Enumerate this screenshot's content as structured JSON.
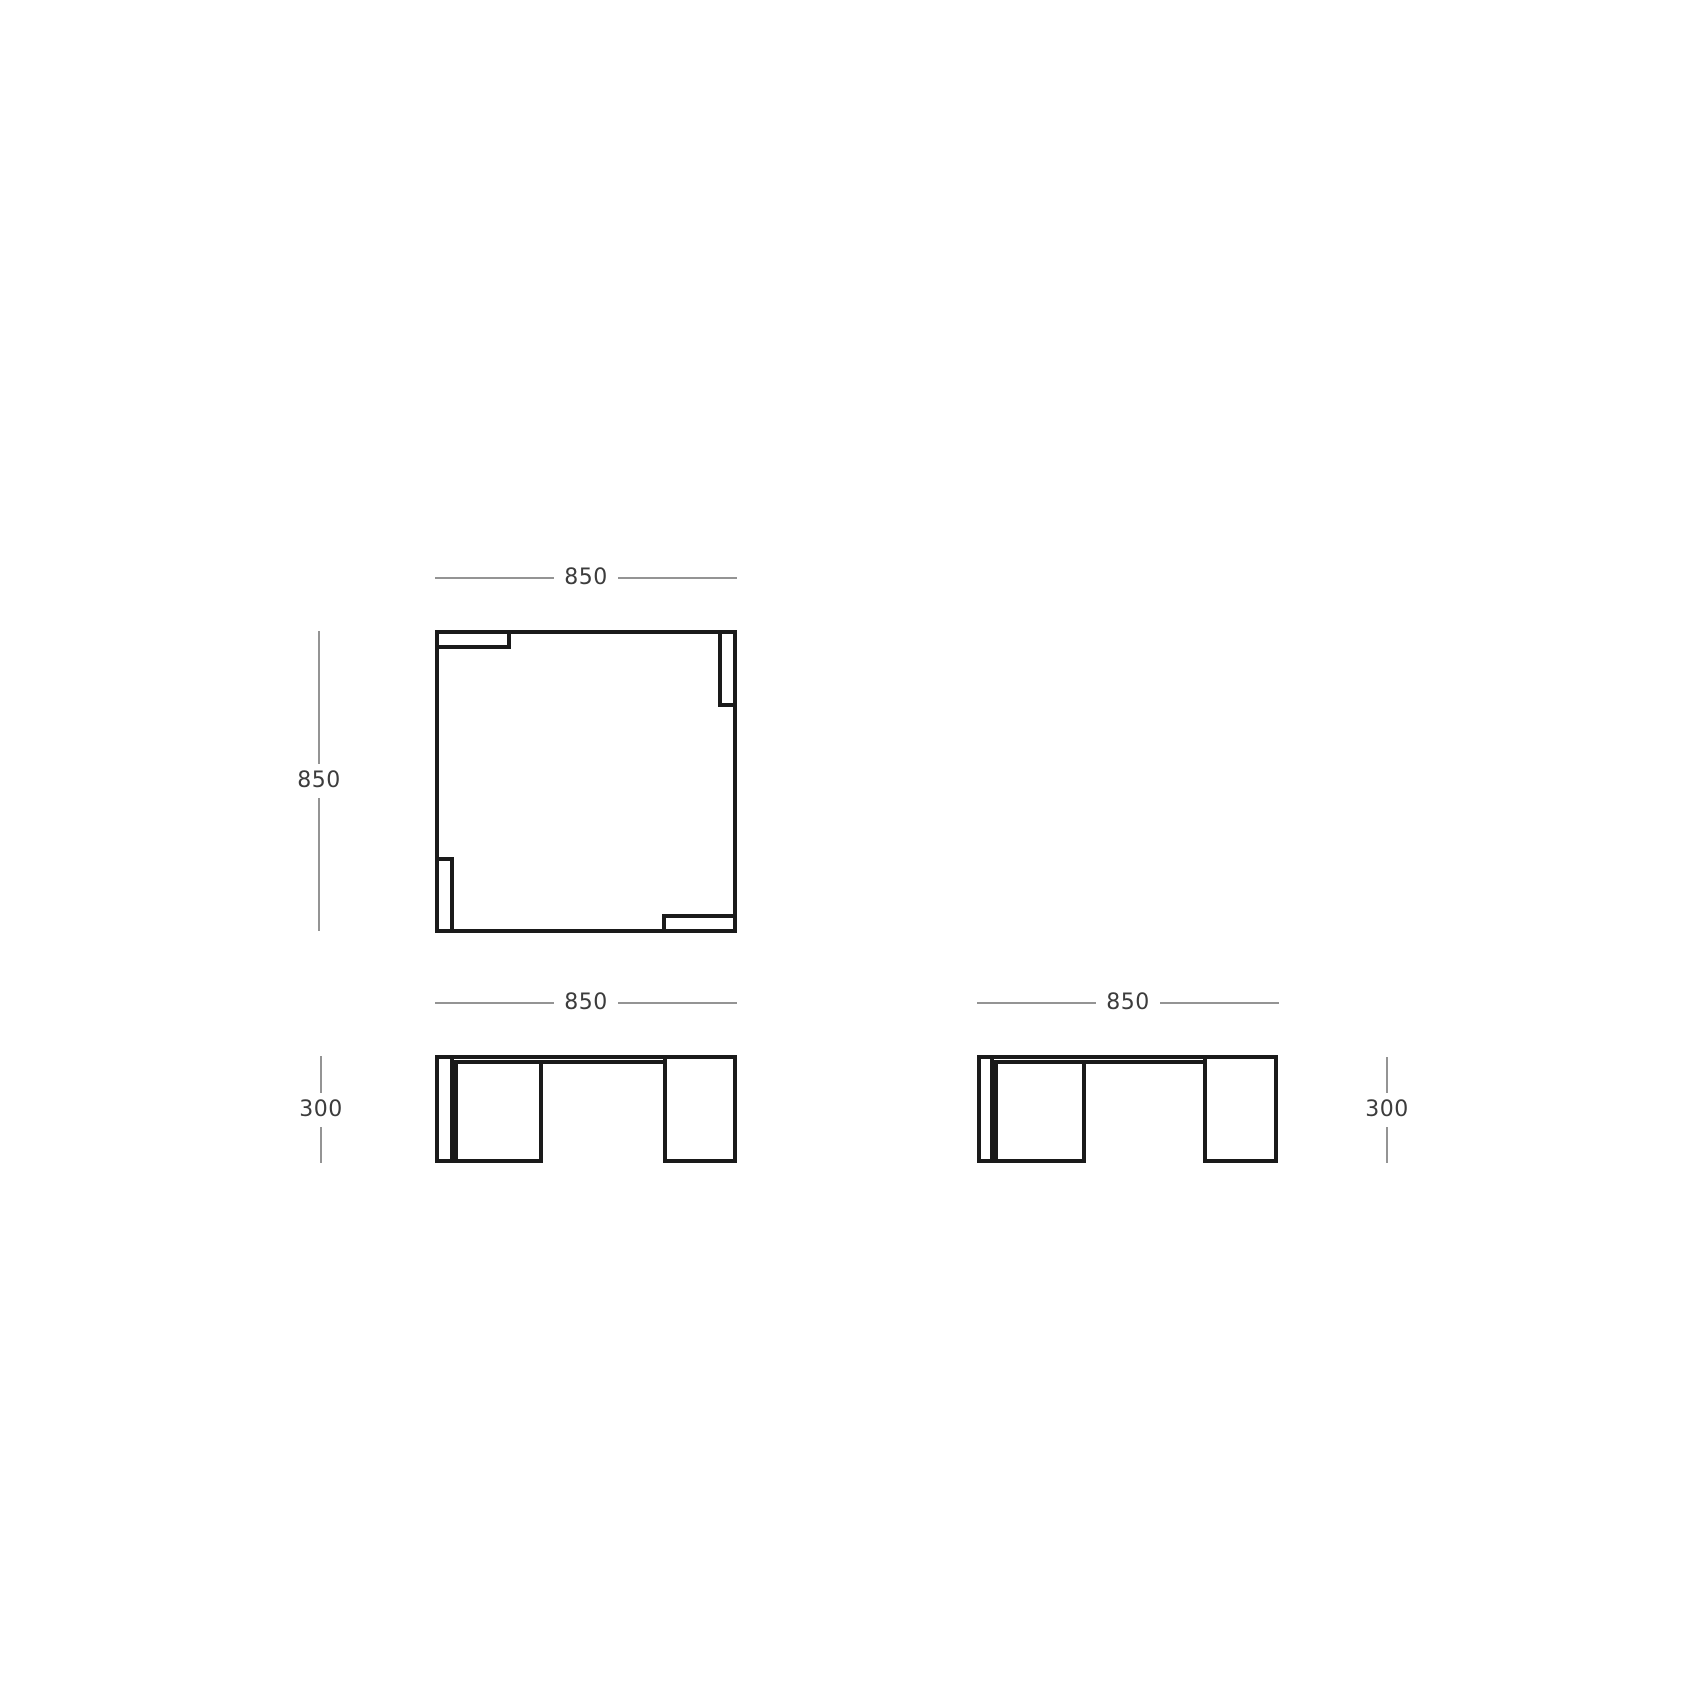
{
  "views": {
    "plan": {
      "width_label": "850",
      "height_label": "850"
    },
    "front": {
      "width_label": "850",
      "height_label": "300"
    },
    "side": {
      "width_label": "850",
      "height_label": "300"
    }
  },
  "colors": {
    "drawing_line": "#1a1a1a",
    "dimension_line": "#949494",
    "dimension_text": "#3c3c3c",
    "background": "#ffffff"
  }
}
